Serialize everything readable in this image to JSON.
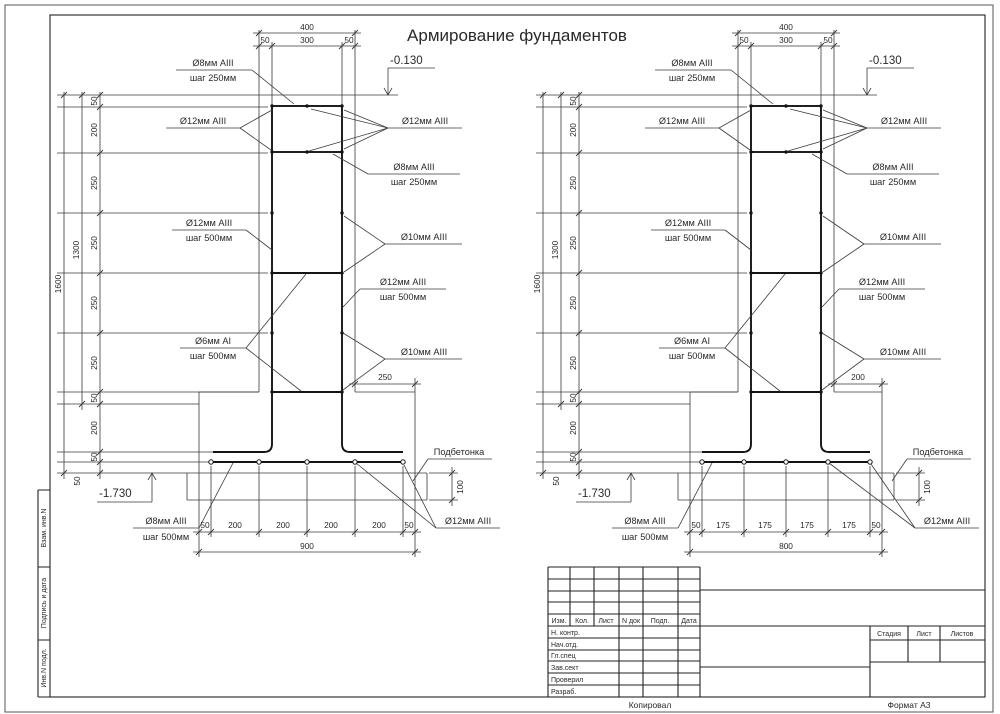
{
  "sheet": {
    "title": "Армирование фундаментов",
    "copied": "Копировал",
    "format": "Формат А3"
  },
  "side_stamps": [
    "Взам. инв.N",
    "Подпись и дата",
    "Инв.N подл."
  ],
  "title_block": {
    "change_header": [
      "Изм.",
      "Кол.",
      "Лист",
      "N док",
      "Подп.",
      "Дата"
    ],
    "signature_rows": [
      "Н. контр.",
      "Нач.отд.",
      "Гл.спец",
      "Зав.сект",
      "Проверил",
      "Разраб."
    ],
    "stage_header": [
      "Стадия",
      "Лист",
      "Листов"
    ]
  },
  "annotations": {
    "top_mesh": {
      "l1": "Ø8мм AIII",
      "l2": "шаг 250мм"
    },
    "corner_bars": "Ø12мм AIII",
    "wall_vert": {
      "l1": "Ø12мм AIII",
      "l2": "шаг 500мм"
    },
    "wall_ties": {
      "l1": "Ø6мм AI",
      "l2": "шаг 500мм"
    },
    "wall_horiz": "Ø10мм AIII",
    "footing_mesh": {
      "l1": "Ø8мм AIII",
      "l2": "шаг 500мм"
    },
    "blinding": "Подбетонка",
    "footing_bars": "Ø12мм AIII",
    "elev_top": "-0.130",
    "elev_bottom": "-1.730"
  },
  "dims": {
    "top_total": "400",
    "top": [
      "50",
      "300",
      "50"
    ],
    "height_total": "1600",
    "height_wall": "1300",
    "chain": [
      "50",
      "200",
      "250",
      "250",
      "250",
      "250",
      "50",
      "200",
      "50",
      "50"
    ],
    "blinding_h": "100"
  },
  "drawings": [
    {
      "ledge": "250",
      "bottom_chain": [
        "50",
        "200",
        "200",
        "200",
        "200",
        "50"
      ],
      "bottom_total": "900"
    },
    {
      "ledge": "200",
      "bottom_chain": [
        "50",
        "175",
        "175",
        "175",
        "175",
        "50"
      ],
      "bottom_total": "800"
    }
  ]
}
